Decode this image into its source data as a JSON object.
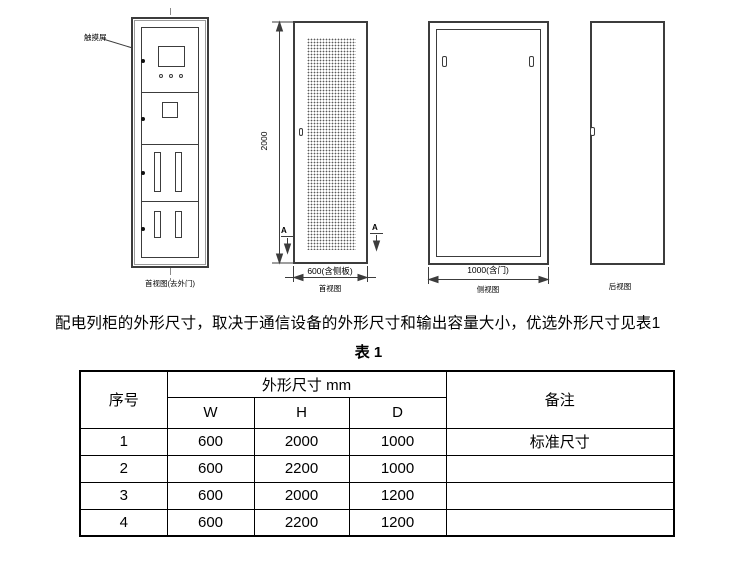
{
  "colors": {
    "background": "#ffffff",
    "line": "#3c3c3c",
    "text": "#000000"
  },
  "drawings": {
    "front_open": {
      "caption": "首视图(去外门)",
      "touchscreen_label": "触摸屏"
    },
    "front": {
      "caption": "首视图",
      "height_dim": "2000",
      "width_dim": "600(含侧板)",
      "section_marker_left": "A",
      "section_marker_right": "A"
    },
    "side": {
      "caption": "侧视图",
      "depth_dim": "1000(含门)"
    },
    "rear": {
      "caption": "后视图"
    }
  },
  "paragraph": "配电列柜的外形尺寸，取决于通信设备的外形尺寸和输出容量大小，优选外形尺寸见表1",
  "table": {
    "title": "表 1",
    "headers": {
      "index": "序号",
      "dims_group": "外形尺寸 mm",
      "w": "W",
      "h": "H",
      "d": "D",
      "remark": "备注"
    },
    "rows": [
      {
        "index": "1",
        "w": "600",
        "h": "2000",
        "d": "1000",
        "remark": "标准尺寸"
      },
      {
        "index": "2",
        "w": "600",
        "h": "2200",
        "d": "1000",
        "remark": ""
      },
      {
        "index": "3",
        "w": "600",
        "h": "2000",
        "d": "1200",
        "remark": ""
      },
      {
        "index": "4",
        "w": "600",
        "h": "2200",
        "d": "1200",
        "remark": ""
      }
    ]
  }
}
